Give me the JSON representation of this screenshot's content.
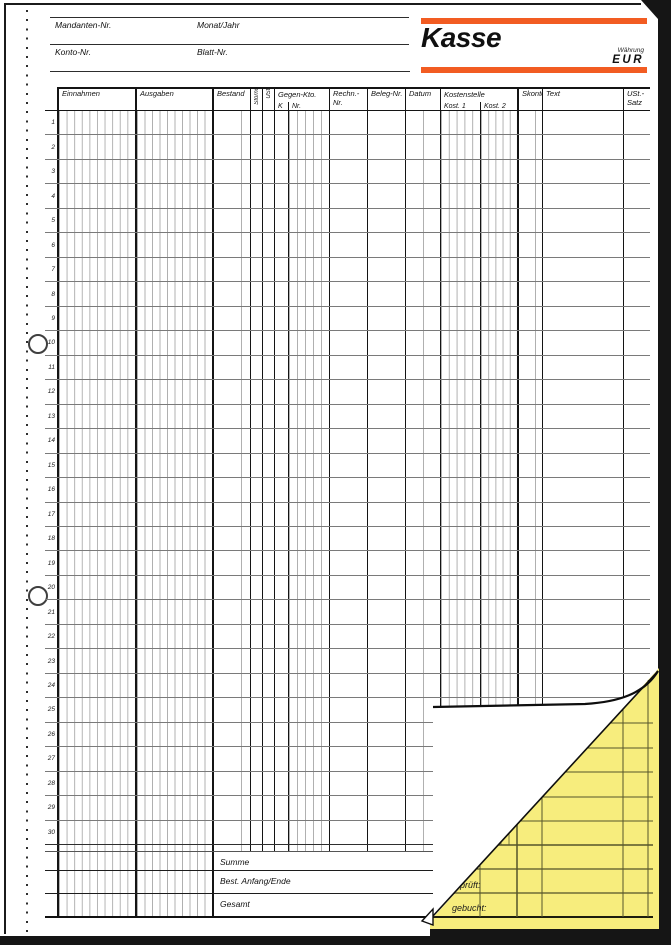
{
  "meta": {
    "mandant": "Mandanten-Nr.",
    "monat": "Monat/Jahr",
    "konto": "Konto-Nr.",
    "blatt": "Blatt-Nr."
  },
  "brand": {
    "title": "Kasse",
    "currency_label": "Währung",
    "currency_code": "EUR",
    "accent_color": "#F25C22"
  },
  "table": {
    "headers": {
      "einnahmen": "Einnahmen",
      "ausgaben": "Ausgaben",
      "bestand": "Bestand",
      "storno": "Storno",
      "ust": "USt.",
      "gegenkto": "Gegen-Kto.",
      "k": "K",
      "nr": "Nr.",
      "rechn": "Rechn.-Nr.",
      "beleg": "Beleg-Nr.",
      "datum": "Datum",
      "kostenstelle": "Kostenstelle",
      "kost1": "Kost. 1",
      "kost2": "Kost. 2",
      "skonto": "Skonto",
      "text": "Text",
      "ustsatz": "USt.-Satz"
    },
    "row_numbers": [
      1,
      2,
      3,
      4,
      5,
      6,
      7,
      8,
      9,
      10,
      11,
      12,
      13,
      14,
      15,
      16,
      17,
      18,
      19,
      20,
      21,
      22,
      23,
      24,
      25,
      26,
      27,
      28,
      29,
      30
    ],
    "summary": {
      "summe": "Summe",
      "bestand_anfang_ende": "Best. Anfang/Ende",
      "gesamt": "Gesamt"
    }
  },
  "copy_sheet": {
    "color": "#F7ED7D",
    "signatures": [
      "geprüft",
      "geprüft:",
      "gebucht:"
    ]
  }
}
